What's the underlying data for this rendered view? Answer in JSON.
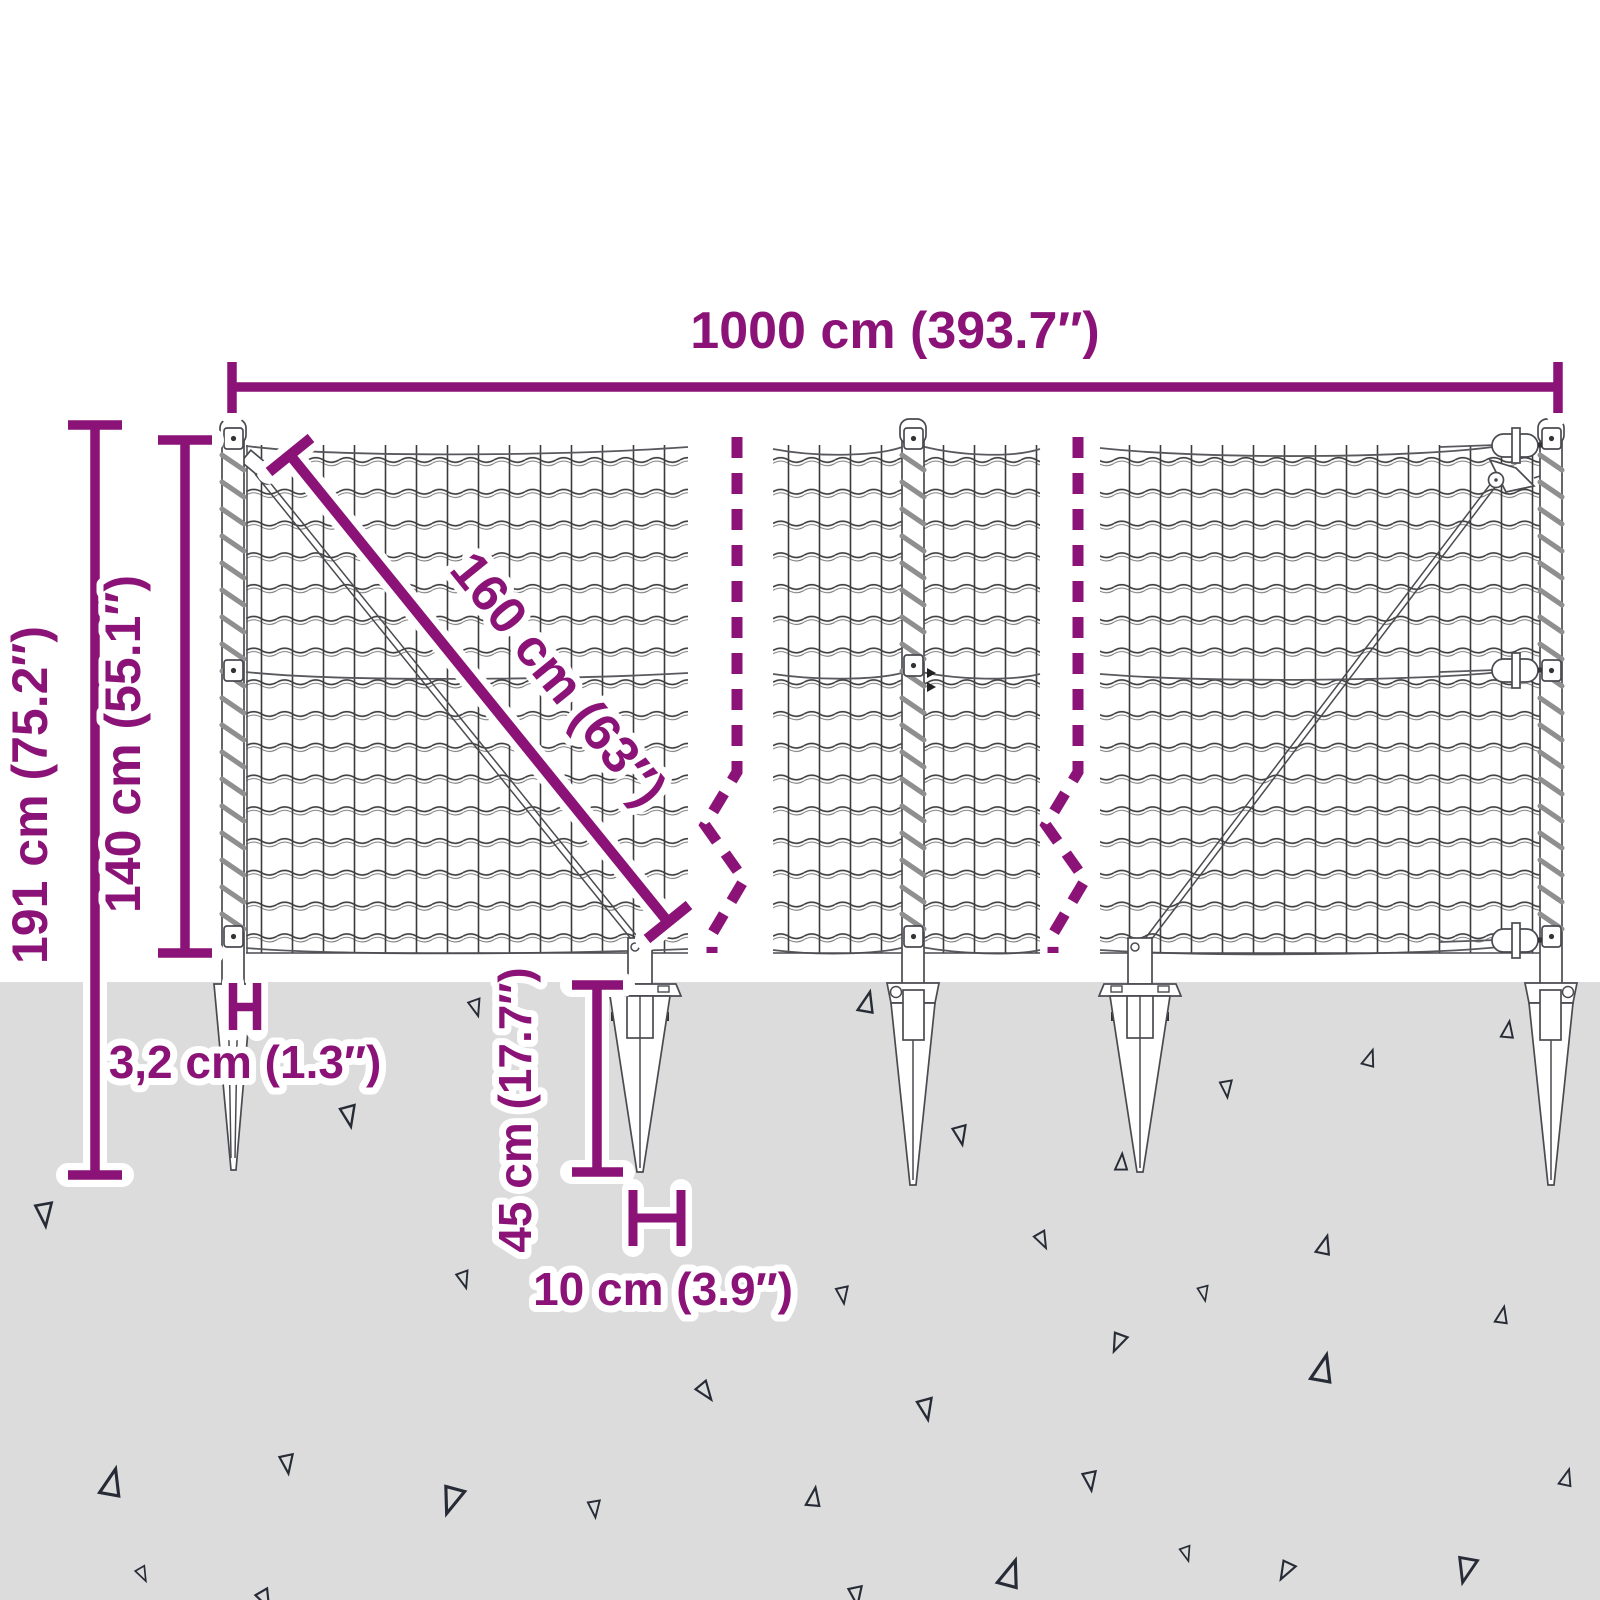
{
  "diagram": {
    "title": "Wire mesh fence with spike anchors – dimension diagram",
    "dimensions": {
      "total_width": "1000 cm (393.7″)",
      "overall_height": "191 cm (75.2″)",
      "fence_height": "140 cm (55.1″)",
      "panel_diagonal": "160 cm (63″)",
      "post_width": "3,2 cm (1.3″)",
      "spike_depth": "45 cm (17.7″)",
      "spike_width": "10 cm (3.9″)"
    },
    "colors": {
      "dimension_accent": "#8B1377",
      "ground": "#DCDCDC",
      "line_art": "#3B3B3B",
      "texture_triangles": "#262B36",
      "background": "#FFFFFF"
    }
  }
}
